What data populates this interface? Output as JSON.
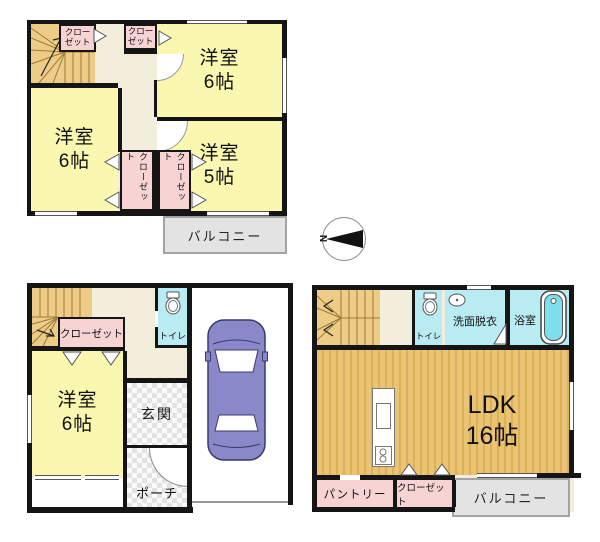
{
  "compass": {
    "label": "N"
  },
  "plan_top": {
    "closet_a": "クロー\nゼット",
    "closet_b": "クロー\nゼット",
    "room_top_right": {
      "name": "洋室",
      "size": "6帖"
    },
    "room_left": {
      "name": "洋室",
      "size": "6帖"
    },
    "room_bottom_right": {
      "name": "洋室",
      "size": "5帖"
    },
    "closet_c": "クローゼット",
    "closet_d": "クローゼット",
    "balcony": "バルコニー"
  },
  "plan_bottom_left": {
    "closet": "クローゼット",
    "toilet": "トイレ",
    "room": {
      "name": "洋室",
      "size": "6帖"
    },
    "entrance": "玄関",
    "porch": "ポーチ"
  },
  "plan_bottom_right": {
    "toilet": "トイレ",
    "washroom": "洗面脱衣",
    "bath": "浴室",
    "ldk": {
      "name": "LDK",
      "size": "16帖"
    },
    "pantry": "パントリー",
    "closet": "クローゼット",
    "balcony": "バルコニー"
  },
  "colors": {
    "room_yellow": "#FAF8B0",
    "closet_pink": "#F7D3D3",
    "stairs_tan": "#EDCD86",
    "hallway_cream": "#F3EDDB",
    "wet_cyan": "#B9EBF3",
    "ldk_wood": "#EAC474",
    "balcony_gray": "#E3E3E3",
    "car_purple": "#8A88C8",
    "wall_black": "#151515"
  }
}
